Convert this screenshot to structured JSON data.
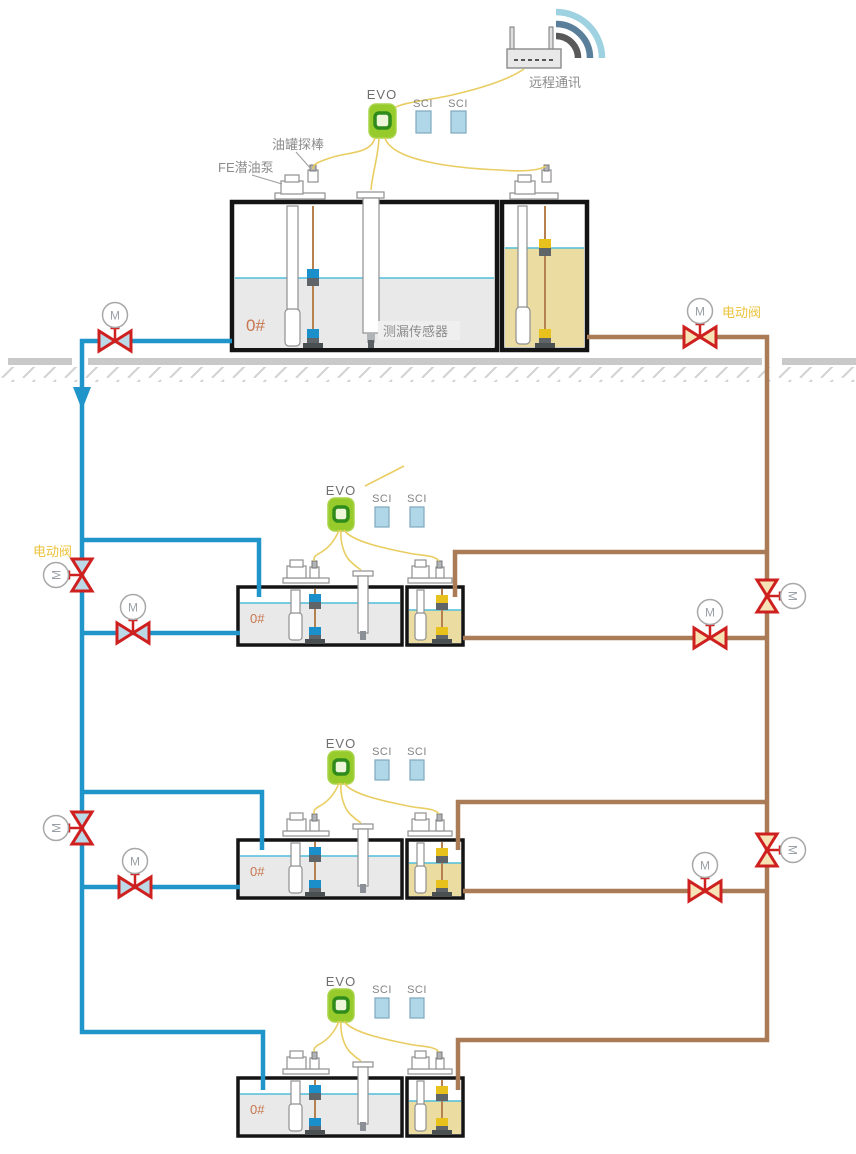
{
  "labels": {
    "remote_comm": "远程通讯",
    "tank_probe": "油罐探棒",
    "submersible_pump": "FE潜油泵",
    "leak_sensor": "测漏传感器",
    "electric_valve": "电动阀",
    "evo": "EVO",
    "sci": "SCI",
    "fuel_grade": "0#",
    "motor": "M"
  },
  "colors": {
    "pipe_blue": "#2095c9",
    "pipe_brown": "#aa7b57",
    "valve_red": "#cf2020",
    "evo_green": "#97cb2c",
    "sci_blue": "#afd7e8",
    "wire_yellow": "#e9cd62",
    "fluid_gray": "#e9e9e9",
    "fluid_tan": "#ebdda2",
    "liquid_line": "#4fbeda",
    "float_blue": "#1b8fc9",
    "float_yellow": "#e9c11d",
    "ground_gray": "#c9c9c9",
    "label_gray": "#8c8c8c",
    "grade_orange": "#c7764e",
    "electric_valve_label": "#ecc23c"
  },
  "system": {
    "station_count": 4,
    "fuel_grade_all_tanks": "0#",
    "modules_per_station": [
      "EVO",
      "SCI",
      "SCI"
    ]
  }
}
